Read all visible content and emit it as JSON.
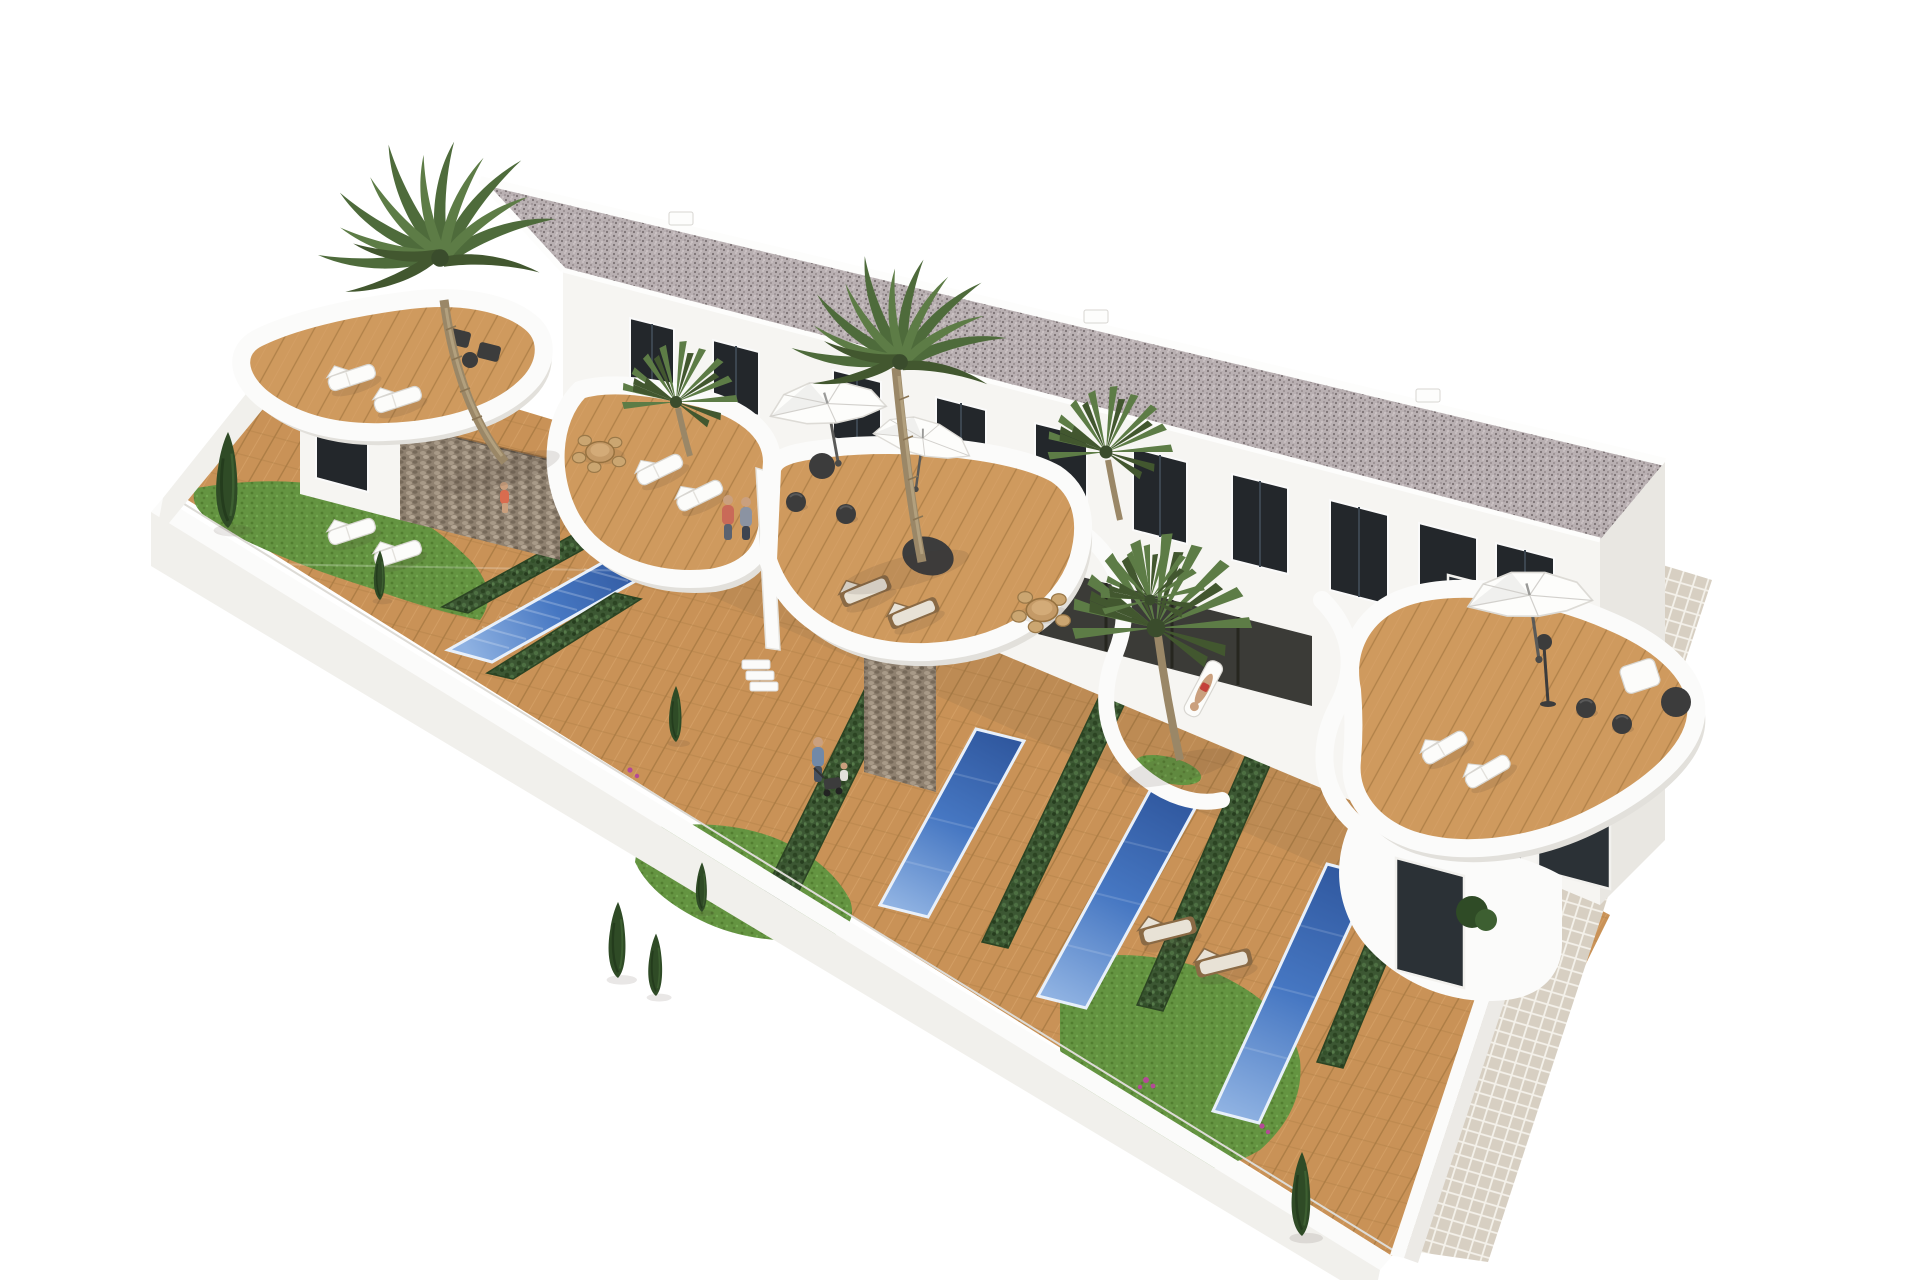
{
  "scene": {
    "title": "Aerial 3D architectural render of a modern white townhouse complex with private gardens, pools and roof terraces",
    "type": "architectural-visualization",
    "colors": {
      "background": "#ffffff",
      "facade": "#f6f5f2",
      "facade_shade": "#eceae6",
      "end_wall": "#e9e7e2",
      "roof_base": "#b9b0b2",
      "roof_dot_dark": "#7b7173",
      "roof_dot_mid": "#958b8e",
      "roof_dot_light": "#d0c7c9",
      "parapet_white": "#fdfdfc",
      "window_glass": "#23272b",
      "window_frame": "#fafafa",
      "glazing_dark": "#2b3136",
      "porch_dark": "#3b3b37",
      "wood_base": "#c99257",
      "wood_stripe": "#a97a43",
      "wood_light": "#d7a369",
      "deck_terrace": "#cf9a5e",
      "pool_deep": "#30589f",
      "pool_mid": "#4677c2",
      "pool_light": "#8fb2e2",
      "pool_rim": "#e8f0fa",
      "hedge_base": "#3c5733",
      "hedge_dark": "#2c4423",
      "grass_base": "#649441",
      "grass_dark": "#527d30",
      "stone_base": "#8f8170",
      "stone_light": "#a89a88",
      "stone_dark": "#776a5a",
      "tile_base": "#d7cfc2",
      "tile_joint": "#f4f1ea",
      "wall_white": "#fbfbfa",
      "wall_face": "#f1f0ec",
      "parasol_white": "#fdfdfb",
      "furniture_dark": "#3c3c3c",
      "lounger_white": "#fcfcfa",
      "lounger_wood": "#8a6a45",
      "cushion": "#e8e2d6",
      "palm_frond_a": "#4e6b3b",
      "palm_frond_b": "#5d7c46",
      "palm_frond_c": "#42572f",
      "palm_trunk": "#9a8767",
      "conifer_green": "#2f4b26",
      "skin": "#caa07e",
      "accent_coral": "#c96a58",
      "accent_blue": "#7189a8",
      "bougainvillea": "#b44a96",
      "ground_shadow": "rgba(90,78,62,0.10)"
    },
    "building": {
      "floors": 2,
      "units": 4,
      "roof": "flat gravel roof with white parapet",
      "upper_windows": 10,
      "roof_vents": 3,
      "ground_glazing_panels": 2
    },
    "landscape": {
      "pools": 4,
      "palm_trees": 5,
      "conifers": 7,
      "hedges": 6,
      "parasols": 3,
      "sun_loungers_white": 9,
      "sun_loungers_wood": 4,
      "dining_sets": 2,
      "people": 6,
      "perimeter_wall": "white boundary wall",
      "walkway": "beige tiled path along the right side"
    }
  }
}
